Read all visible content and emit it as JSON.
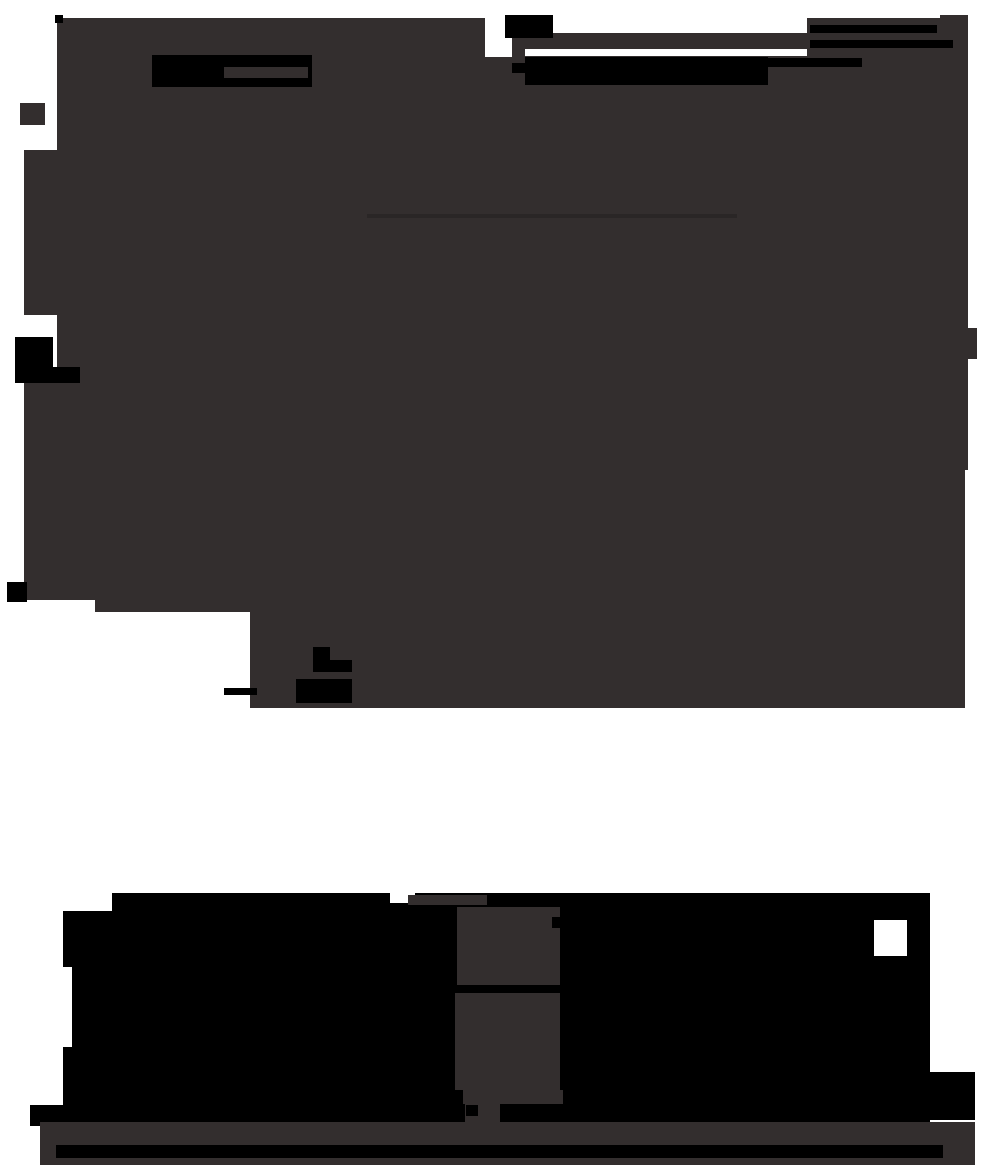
{
  "canvas": {
    "width": 982,
    "height": 1165,
    "background": "#ffffff"
  },
  "palette": {
    "paper": "#ffffff",
    "blob": "#332e2e",
    "ink": "#000000",
    "faint": "#2a2626"
  },
  "shapes": [
    {
      "name": "blob-base",
      "color": "blob",
      "x": 57,
      "y": 18,
      "w": 883,
      "h": 690,
      "dots": true
    },
    {
      "name": "blob-left-column-upper",
      "color": "blob",
      "x": 24,
      "y": 150,
      "w": 33,
      "h": 165
    },
    {
      "name": "blob-left-column-lower",
      "color": "blob",
      "x": 24,
      "y": 383,
      "w": 33,
      "h": 217
    },
    {
      "name": "blob-right-column",
      "color": "blob",
      "x": 940,
      "y": 15,
      "w": 28,
      "h": 455
    },
    {
      "name": "blob-right-bump",
      "color": "blob",
      "x": 960,
      "y": 328,
      "w": 17,
      "h": 31
    },
    {
      "name": "blob-right-lower",
      "color": "blob",
      "x": 940,
      "y": 470,
      "w": 25,
      "h": 238
    },
    {
      "name": "blob-corner-square",
      "color": "blob",
      "x": 20,
      "y": 103,
      "w": 25,
      "h": 22
    },
    {
      "name": "notch-top-center-left",
      "color": "paper",
      "x": 485,
      "y": 15,
      "w": 27,
      "h": 42
    },
    {
      "name": "notch-top-center-wide",
      "color": "paper",
      "x": 553,
      "y": 18,
      "w": 254,
      "h": 15
    },
    {
      "name": "notch-nav-gap",
      "color": "paper",
      "x": 525,
      "y": 49,
      "w": 282,
      "h": 7
    },
    {
      "name": "notch-bottom-left-1",
      "color": "paper",
      "x": 24,
      "y": 600,
      "w": 71,
      "h": 110
    },
    {
      "name": "notch-bottom-left-2",
      "color": "paper",
      "x": 95,
      "y": 612,
      "w": 155,
      "h": 98
    },
    {
      "name": "logo-block",
      "color": "ink",
      "x": 152,
      "y": 55,
      "w": 160,
      "h": 32
    },
    {
      "name": "logo-inset",
      "color": "blob",
      "x": 224,
      "y": 67,
      "w": 84,
      "h": 11
    },
    {
      "name": "top-black-piece",
      "color": "ink",
      "x": 505,
      "y": 15,
      "w": 48,
      "h": 23
    },
    {
      "name": "nav-bar-block",
      "color": "ink",
      "x": 525,
      "y": 57,
      "w": 243,
      "h": 28
    },
    {
      "name": "nav-nub",
      "color": "ink",
      "x": 512,
      "y": 63,
      "w": 13,
      "h": 10
    },
    {
      "name": "nav-tail-line",
      "color": "ink",
      "x": 768,
      "y": 58,
      "w": 94,
      "h": 9
    },
    {
      "name": "top-line-1",
      "color": "ink",
      "x": 810,
      "y": 25,
      "w": 127,
      "h": 8
    },
    {
      "name": "top-line-2",
      "color": "ink",
      "x": 810,
      "y": 40,
      "w": 143,
      "h": 8
    },
    {
      "name": "small-mark-top-left",
      "color": "ink",
      "x": 55,
      "y": 15,
      "w": 8,
      "h": 8
    },
    {
      "name": "left-black-tab",
      "color": "ink",
      "x": 15,
      "y": 337,
      "w": 38,
      "h": 46
    },
    {
      "name": "left-black-tab-step",
      "color": "ink",
      "x": 53,
      "y": 367,
      "w": 27,
      "h": 16
    },
    {
      "name": "left-black-mark",
      "color": "ink",
      "x": 7,
      "y": 582,
      "w": 20,
      "h": 20
    },
    {
      "name": "faint-interior-line",
      "color": "faint",
      "x": 367,
      "y": 214,
      "w": 370,
      "h": 4
    },
    {
      "name": "glyph-l-nub",
      "color": "ink",
      "x": 313,
      "y": 647,
      "w": 17,
      "h": 13
    },
    {
      "name": "glyph-l-bar",
      "color": "ink",
      "x": 313,
      "y": 660,
      "w": 39,
      "h": 12
    },
    {
      "name": "glyph-block",
      "color": "ink",
      "x": 296,
      "y": 679,
      "w": 56,
      "h": 24
    },
    {
      "name": "glyph-dash",
      "color": "ink",
      "x": 224,
      "y": 688,
      "w": 33,
      "h": 7
    },
    {
      "name": "letter-left-block",
      "color": "ink",
      "x": 63,
      "y": 893,
      "w": 392,
      "h": 233
    },
    {
      "name": "letter-left-foot",
      "color": "ink",
      "x": 30,
      "y": 1105,
      "w": 33,
      "h": 21
    },
    {
      "name": "letter-mid-backing",
      "color": "ink",
      "x": 455,
      "y": 893,
      "w": 105,
      "h": 233
    },
    {
      "name": "letter-right-block",
      "color": "ink",
      "x": 560,
      "y": 893,
      "w": 370,
      "h": 233
    },
    {
      "name": "letter-right-foot",
      "color": "ink",
      "x": 860,
      "y": 1072,
      "w": 115,
      "h": 48
    },
    {
      "name": "notch-letter-left-top",
      "color": "paper",
      "x": 63,
      "y": 893,
      "w": 49,
      "h": 18
    },
    {
      "name": "notch-letter-left-edge",
      "color": "paper",
      "x": 63,
      "y": 967,
      "w": 9,
      "h": 80
    },
    {
      "name": "notch-letter-left-dent",
      "color": "paper",
      "x": 390,
      "y": 893,
      "w": 25,
      "h": 10
    },
    {
      "name": "notch-letter-right-edge",
      "color": "paper",
      "x": 874,
      "y": 920,
      "w": 33,
      "h": 36
    },
    {
      "name": "mid-gray-strip",
      "color": "blob",
      "x": 408,
      "y": 895,
      "w": 79,
      "h": 10
    },
    {
      "name": "mid-gray-block-1",
      "color": "blob",
      "x": 457,
      "y": 907,
      "w": 103,
      "h": 78
    },
    {
      "name": "mid-gray-block-2",
      "color": "blob",
      "x": 455,
      "y": 993,
      "w": 105,
      "h": 97
    },
    {
      "name": "mid-black-nub",
      "color": "ink",
      "x": 552,
      "y": 917,
      "w": 8,
      "h": 11
    },
    {
      "name": "mid-gray-t-piece",
      "color": "blob",
      "x": 463,
      "y": 1090,
      "w": 100,
      "h": 14
    },
    {
      "name": "mid-gray-t-stem",
      "color": "blob",
      "x": 465,
      "y": 1104,
      "w": 35,
      "h": 22
    },
    {
      "name": "mid-t-black-mark",
      "color": "ink",
      "x": 466,
      "y": 1105,
      "w": 12,
      "h": 11
    },
    {
      "name": "bottom-bar",
      "color": "blob",
      "x": 40,
      "y": 1122,
      "w": 935,
      "h": 43
    },
    {
      "name": "bottom-bar-strip",
      "color": "ink",
      "x": 56,
      "y": 1145,
      "w": 887,
      "h": 13
    }
  ]
}
